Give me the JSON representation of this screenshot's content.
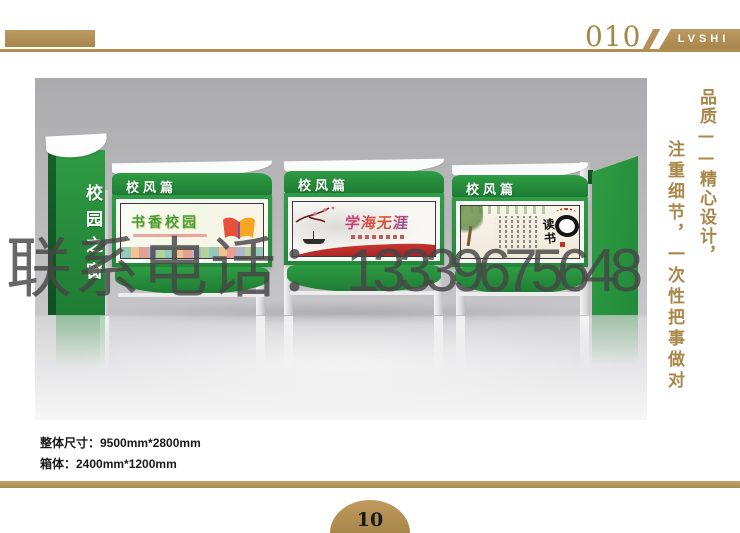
{
  "header": {
    "page_code": "010",
    "brand": "LVSHI"
  },
  "watermark": {
    "label": "联系电话：",
    "phone": "13339675648"
  },
  "slogan": {
    "right_column": "品质——精心设计，",
    "left_column": "注重细节，一次性把事做对"
  },
  "stand": {
    "totem_label": "校园之窗",
    "panels": [
      {
        "header_label": "校风篇",
        "poster_title": "书香校园"
      },
      {
        "header_label": "校风篇",
        "poster_title": "学海无涯"
      },
      {
        "header_label": "校风篇",
        "poster_title": "读书"
      }
    ]
  },
  "specs": {
    "line1": "整体尺寸：9500mm*2800mm",
    "line2": "箱体：2400mm*1200mm"
  },
  "footer": {
    "page_number": "10"
  },
  "colors": {
    "tan": "#b2925a",
    "green": "#2f9c44",
    "dark_green": "#15612a",
    "watermark_gray": "#464646"
  }
}
